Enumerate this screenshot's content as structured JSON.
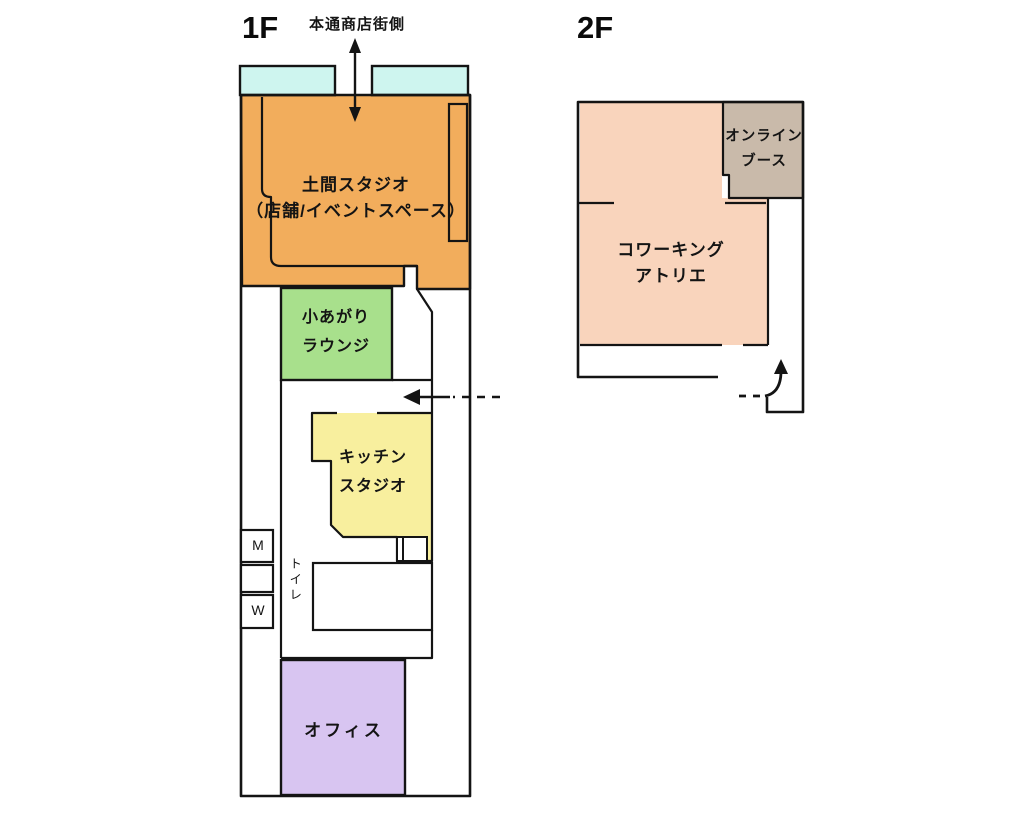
{
  "floor1": {
    "title": "1F",
    "street_label": "本通商店街側",
    "doma_studio_label": "土間スタジオ\n（店舗/イベントスペース）",
    "koagari_label": "小あがり\nラウンジ",
    "kitchen_label": "キッチン\nスタジオ",
    "office_label": "オフィス",
    "toilet_label": "トイレ",
    "toilet_men": "M",
    "toilet_women": "W"
  },
  "floor2": {
    "title": "2F",
    "coworking_label": "コワーキング\nアトリエ",
    "online_booth_label": "オンライン\nブース"
  },
  "colors": {
    "window": "#cef5ef",
    "doma_studio": "#f2ad5c",
    "koagari": "#a8e08c",
    "kitchen": "#f8ef9e",
    "office": "#d8c5f1",
    "coworking": "#f9d4bc",
    "online_booth": "#c9baaa",
    "wall": "#141414",
    "background": "#ffffff"
  }
}
